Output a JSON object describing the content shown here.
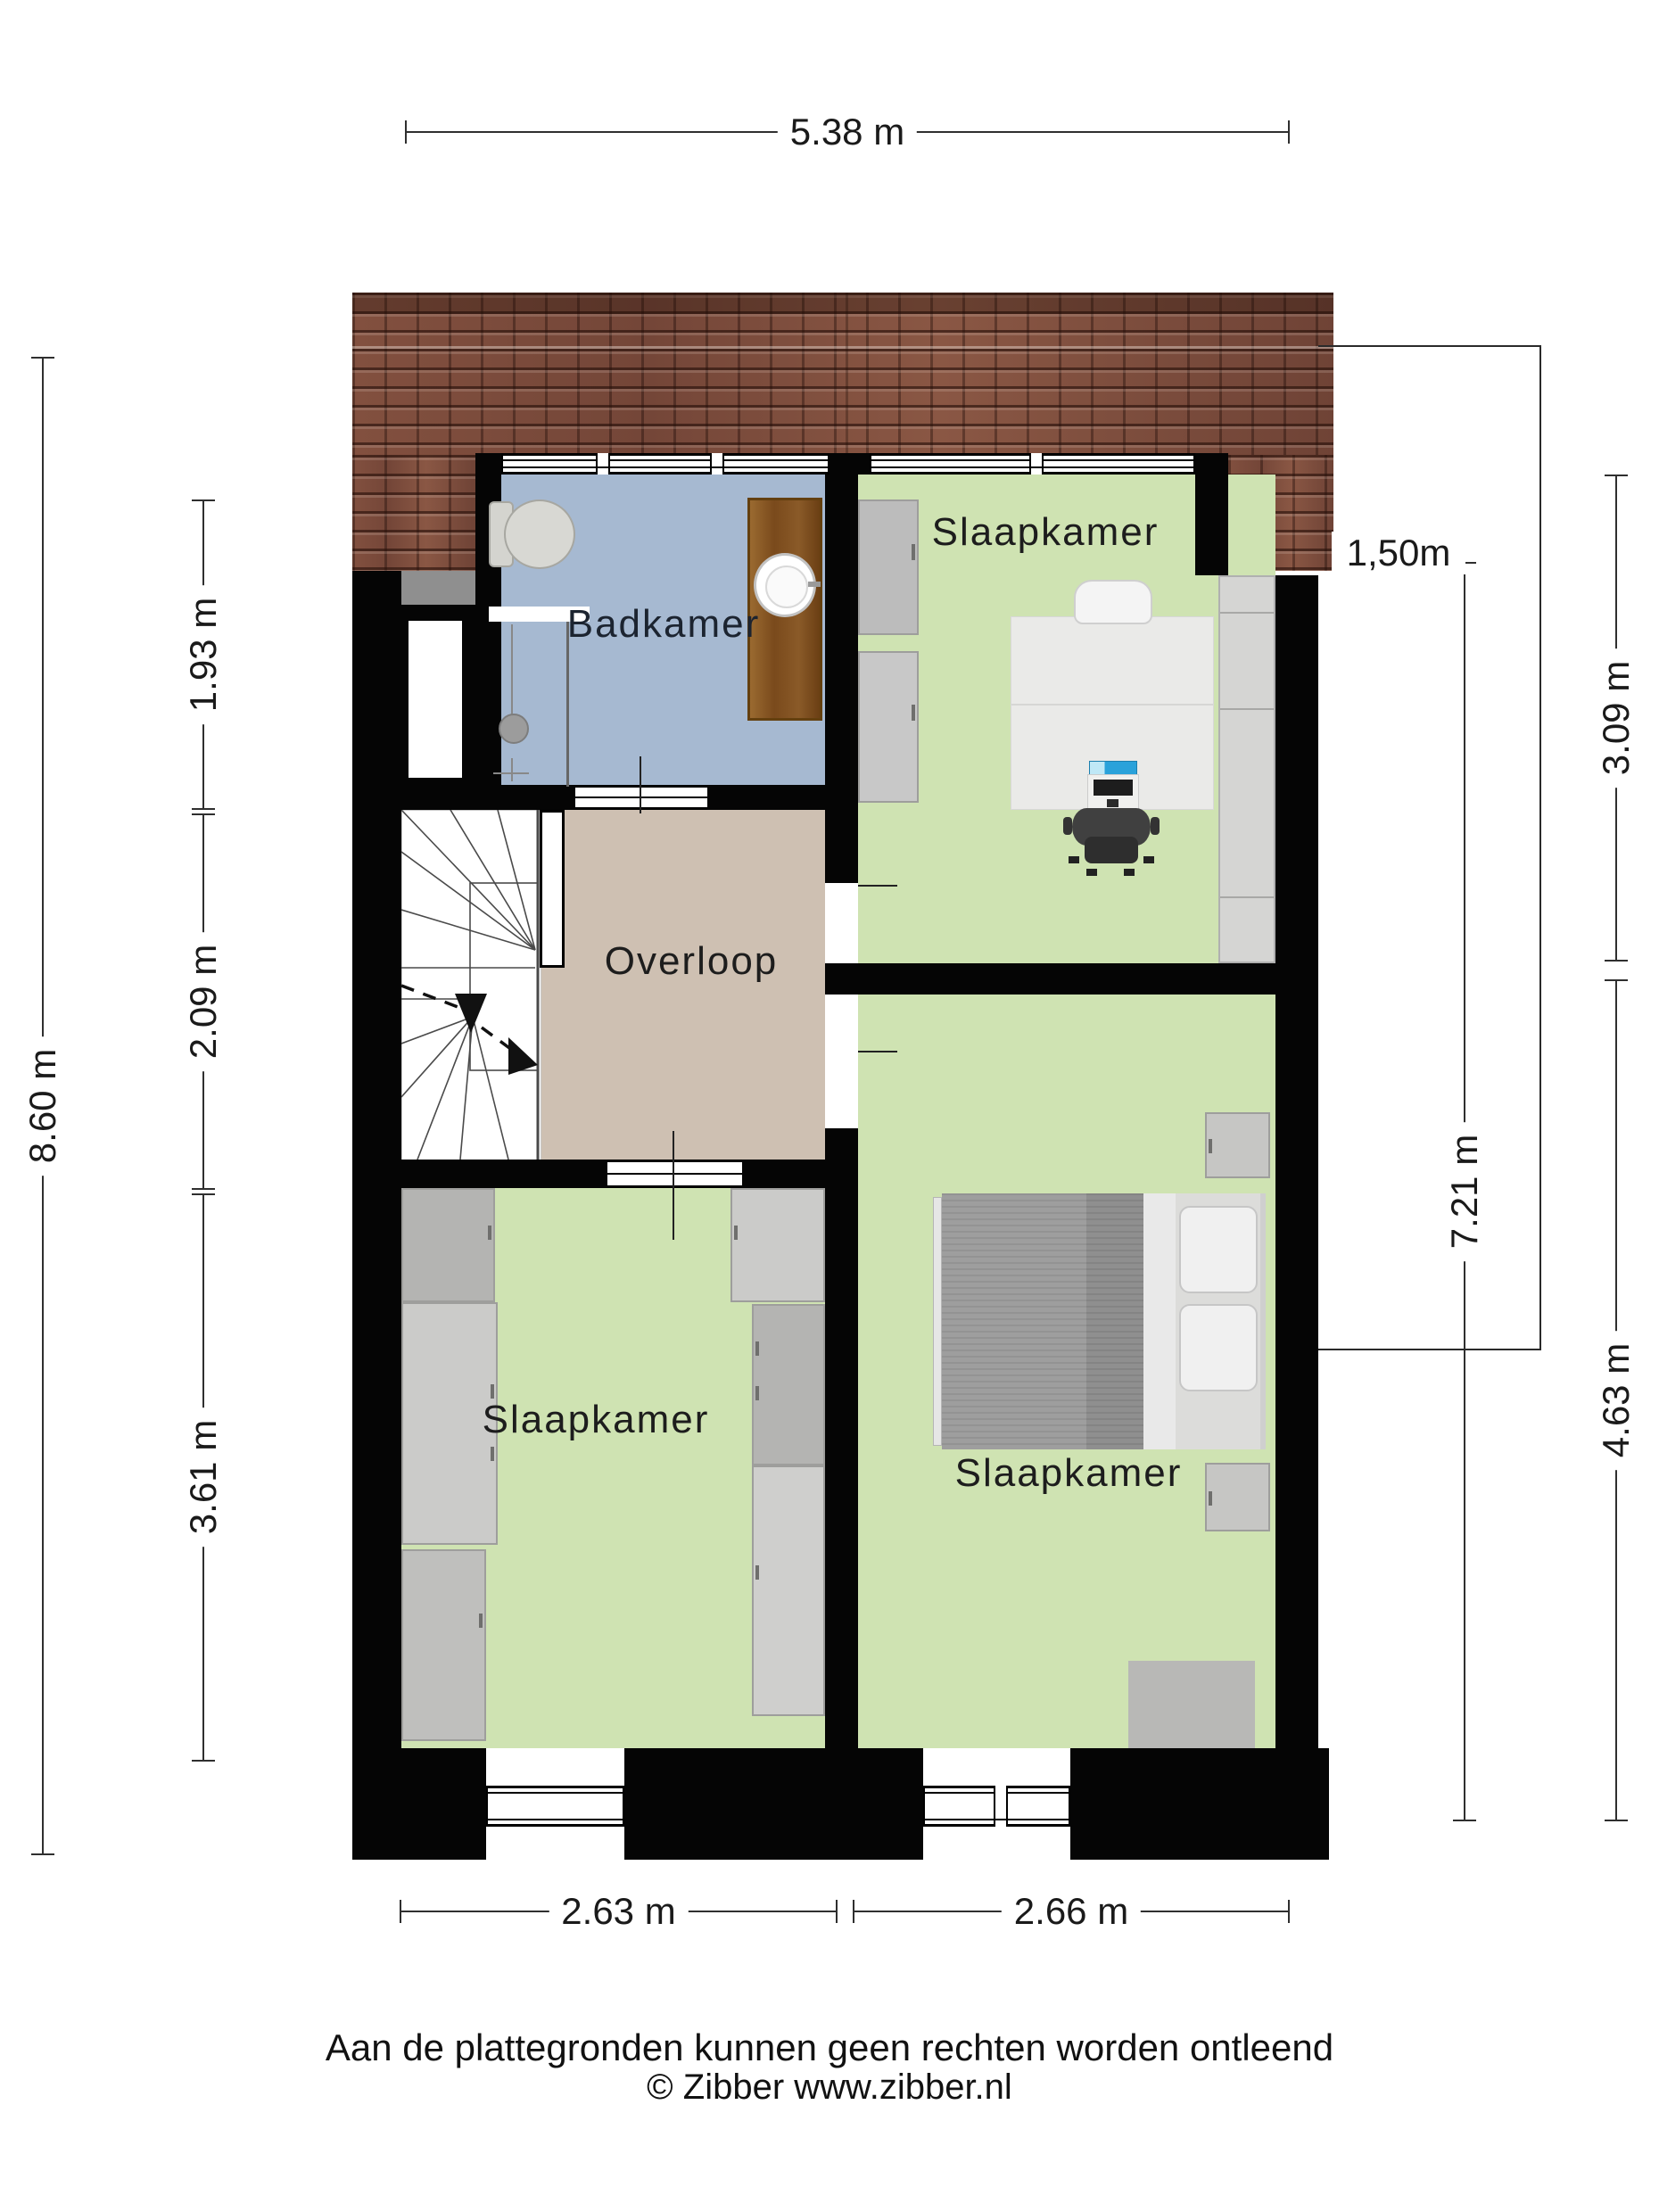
{
  "plan": {
    "rooms": {
      "bathroom": {
        "label": "Badkamer"
      },
      "bedroom_top": {
        "label": "Slaapkamer"
      },
      "landing": {
        "label": "Overloop"
      },
      "bedroom_left": {
        "label": "Slaapkamer"
      },
      "bedroom_right": {
        "label": "Slaapkamer"
      }
    },
    "dimensions": {
      "top_width": "5.38 m",
      "left_total": "8.60 m",
      "left_segments": [
        "1.93 m",
        "2.09 m",
        "3.61 m"
      ],
      "right_inner": "7.21 m",
      "right_segments": [
        "3.09 m",
        "4.63 m"
      ],
      "headroom": "1,50m",
      "bottom_segments": [
        "2.63 m",
        "2.66 m"
      ]
    },
    "footer": {
      "disclaimer": "Aan de plattegronden kunnen geen rechten worden ontleend",
      "credit": "© Zibber www.zibber.nl"
    },
    "colors": {
      "bathroom_floor": "#a6b9d1",
      "bedroom_floor": "#cfe3b2",
      "landing_floor": "#cec0b2",
      "roof": "#7d4c3e",
      "wall": "#050505"
    }
  }
}
